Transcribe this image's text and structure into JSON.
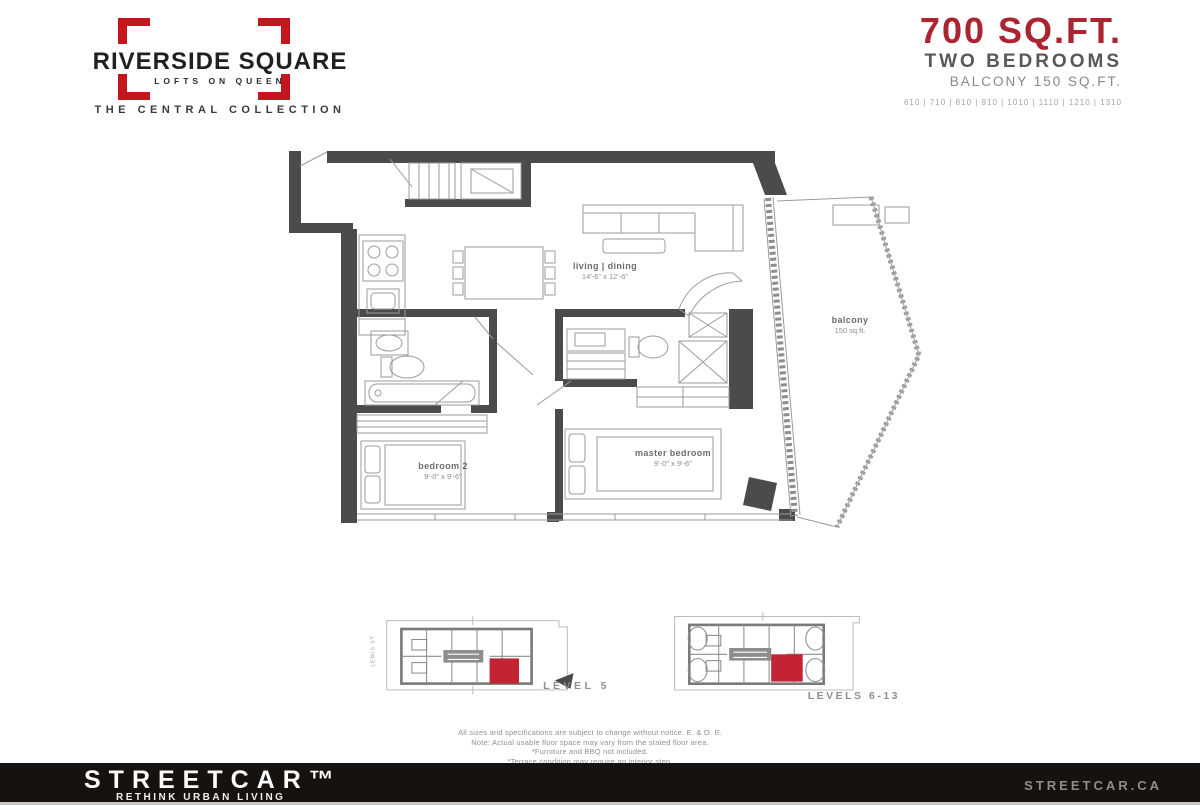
{
  "logo": {
    "title": "RIVERSIDE SQUARE",
    "subtitle": "LOFTS ON QUEEN",
    "collection": "THE CENTRAL COLLECTION"
  },
  "header": {
    "size": "700 SQ.FT.",
    "type": "TWO BEDROOMS",
    "balcony": "BALCONY 150 SQ.FT.",
    "units": "610 | 710 | 810 | 910 | 1010 | 1110 | 1210 | 1310"
  },
  "plan": {
    "living_dining": {
      "label": "living | dining",
      "dims": "14'-6\" x 12'-6\""
    },
    "bedroom2": {
      "label": "bedroom 2",
      "dims": "9'-0\" x 9'-6\""
    },
    "master": {
      "label": "master bedroom",
      "dims": "9'-0\" x 9'-6\""
    },
    "balcony": {
      "label": "balcony",
      "dims": "150 sq.ft."
    }
  },
  "keyplans": {
    "level5": {
      "label": "LEVEL 5",
      "street": "LEWIS ST"
    },
    "levels613": {
      "label": "LEVELS 6-13"
    }
  },
  "disclaimer": {
    "line1": "All sizes and specifications are subject to change without notice. E. & O. E.",
    "line2": "Note: Actual usable floor space may vary from the stated floor area.",
    "line3": "*Furniture and BBQ not included.",
    "line4": "*Terrace condition may require an interior step."
  },
  "footer": {
    "brand": "STREETCAR™",
    "tagline": "RETHINK URBAN LIVING",
    "website": "STREETCAR.CA"
  },
  "colors": {
    "brand_red": "#c4161c",
    "header_red": "#ab2430",
    "keyplan_red": "#c22433",
    "wall_gray": "#4b4b4b",
    "footer_bg": "#16120f"
  }
}
